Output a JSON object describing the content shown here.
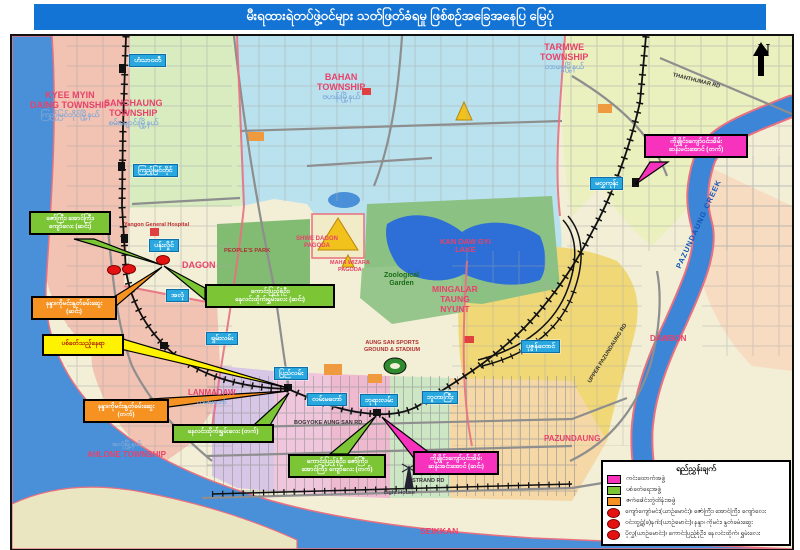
{
  "title": "မီးရထားရဲတပ်ဖွဲ့ဝင်များ သတ်ဖြတ်ခံရမှု ဖြစ်စဉ်အခြေအနေပြ မြေပုံ",
  "north_label": "N",
  "colors": {
    "title_bar": "#1374D6",
    "station_label": "#29A8E0",
    "scout_team": "#F733BE",
    "shooting_team": "#7CC636",
    "engine_team": "#F59222",
    "incident_dot": "#E51212",
    "water": "#4A90D8"
  },
  "stations": [
    {
      "label": "ဟံသာဝတီ"
    },
    {
      "label": "ကြည့်မြင်တိုင်"
    },
    {
      "label": "ပန်းလှိုင်"
    },
    {
      "label": "အလုံ"
    },
    {
      "label": "ရှမ်းလမ်း"
    },
    {
      "label": "ပြည်လမ်း"
    },
    {
      "label": "လမ်းမတော်"
    },
    {
      "label": "ဘုရားလမ်း"
    },
    {
      "label": "ဘူတာကြီး"
    },
    {
      "label": "ပုဇွန်တောင်"
    },
    {
      "label": "မလွှကုန်း"
    }
  ],
  "callouts": [
    {
      "id": "zawgyi-group-down",
      "color": "green",
      "line1": "ဇော်ကြီး၊ အောင်ကြီး၊",
      "line2": "ကျော်လေး (ဆင်း)"
    },
    {
      "id": "kaungpyisoneoo-group-down",
      "color": "green",
      "line1": "ကောင်းပြည့်စုံဦး၊",
      "line2": "နေလင်းထိုက်၊ရွှမ်းလေး (ဆင်း)"
    },
    {
      "id": "nanda-group-down",
      "color": "orange",
      "line1": "နန္ဒာ၊ကိုမင်း၊နွတ်ခမ်းဆွေး",
      "line2": "(ဆင်း)"
    },
    {
      "id": "shooting-site",
      "color": "yellow",
      "line1": "ပစ်ခတ်သည့်နေရာ"
    },
    {
      "id": "nanda-group-up",
      "color": "orange",
      "line1": "နန္ဒာ၊ကိုမင်း၊နွတ်ခမ်းဆွေး",
      "line2": "(တက်)"
    },
    {
      "id": "naelinhtike-group-up",
      "color": "green",
      "line1": "နေလင်းထိုက်၊ရွှမ်းလေး (တက်)"
    },
    {
      "id": "kaungpyisoneoo-group-up",
      "color": "green",
      "line1": "ကောင်းပြည့်စုံဦး၊ ဇော်ကြီး၊",
      "line2": "အောင်ကြီး၊ ကျော်လေး (တက်)"
    },
    {
      "id": "kochaing-group-down",
      "color": "pink",
      "line1": "ကိုချိုင်း၊ကျော်ဝင်းအိမ်း",
      "line2": "ဆန်းအင်းအောင် (ဆင်း)"
    },
    {
      "id": "kochaing-group-up",
      "color": "pink",
      "line1": "ကိုချိုင်း၊ကျော်ဝင်းအိမ်း",
      "line2": "ဆန်းမင်းအောင် (တက်)"
    }
  ],
  "townships": {
    "kyeemyindaing": {
      "en1": "KYEE MYIN",
      "en2": "DAING TOWNSHIP",
      "mm": "ကြည့်မြင်တိုင်မြို့နယ်"
    },
    "sanchaung": {
      "en1": "SANCHAUNG",
      "en2": "TOWNSHIP",
      "mm": "စမ်းချောင်းမြို့နယ်"
    },
    "bahan": {
      "en1": "BAHAN",
      "en2": "TOWNSHIP",
      "mm": "ဗဟန်းမြို့နယ်"
    },
    "tarmwe": {
      "en1": "TARMWE",
      "en2": "TOWNSHIP",
      "mm": "တာမွေမြို့နယ်"
    },
    "dagon": {
      "en1": "DAGON"
    },
    "ahlone": {
      "en1": "AHLONE TOWNSHIP",
      "mm": "အလုံမြို့နယ်"
    },
    "lanmadaw": {
      "en1": "LANMADAW",
      "mm": "လမ်းမတော်"
    },
    "mingalar": {
      "en1": "MINGALAR",
      "en2": "TAUNG",
      "en3": "NYUNT"
    },
    "pazundaung": {
      "en1": "PAZUNDAUNG"
    },
    "seikkan": {
      "en1": "SEIKKAN"
    },
    "dawbon": {
      "en1": "DAWBON"
    }
  },
  "places": {
    "kandawgyi1": "KAN DAW GYI",
    "kandawgyi2": "LAKE",
    "shwedagon1": "SHWE DAGON",
    "shwedagon2": "PAGODA",
    "mahawizara1": "MAHA WIZARA",
    "mahawizara2": "PAGODA",
    "zoo1": "Zoological",
    "zoo2": "Garden",
    "peoples_park": "PEOPLE'S PARK",
    "hospital": "Yangon General Hospital",
    "stadium1": "AUNG SAN SPORTS",
    "stadium2": "GROUND & STADIUM",
    "creek": "PAZUNDAUNG CREEK",
    "bogyoke_rd": "BOGYOKE AUNG SAN RD",
    "strand_rd": "STRAND RD",
    "upper_pazundaung_rd": "UPPER PAZUNDAUNG RD",
    "thanthumar_rd": "THANTHUMAR RD",
    "light_house": "Light House"
  },
  "legend": {
    "title": "ရည်ညွှန်းချက်",
    "items": [
      {
        "type": "swatch",
        "color": "#F733BE",
        "label": "ကင်းထောက်အဖွဲ့"
      },
      {
        "type": "swatch",
        "color": "#7CC636",
        "label": "ပစ်ခတ်ရေးအဖွဲ့"
      },
      {
        "type": "swatch",
        "color": "#F59222",
        "label": "ဇက်ခေါင်းတွဲထိန်းအဖွဲ့"
      },
      {
        "type": "dot",
        "label": "ကျော်ကျော်မင်း(ယာဉ်မောင်း)၊ ဇော်ကြီး၊ အောင်ကြီး၊ ကျော်လေး"
      },
      {
        "type": "dot",
        "label": "ဝင်းထွဋ်(ခ)နဂါး(ယာဉ်မောင်း)၊ နန္ဒာ၊ ကိုမင်း၊ နွတ်ခမ်းဆွေး"
      },
      {
        "type": "dot",
        "label": "ပိုလွှ(ယာဉ်မောင်း)၊ ကောင်းပြည့်စုံဦး၊ နေလင်းထိုက်၊ ရွှမ်းလေး"
      }
    ]
  }
}
